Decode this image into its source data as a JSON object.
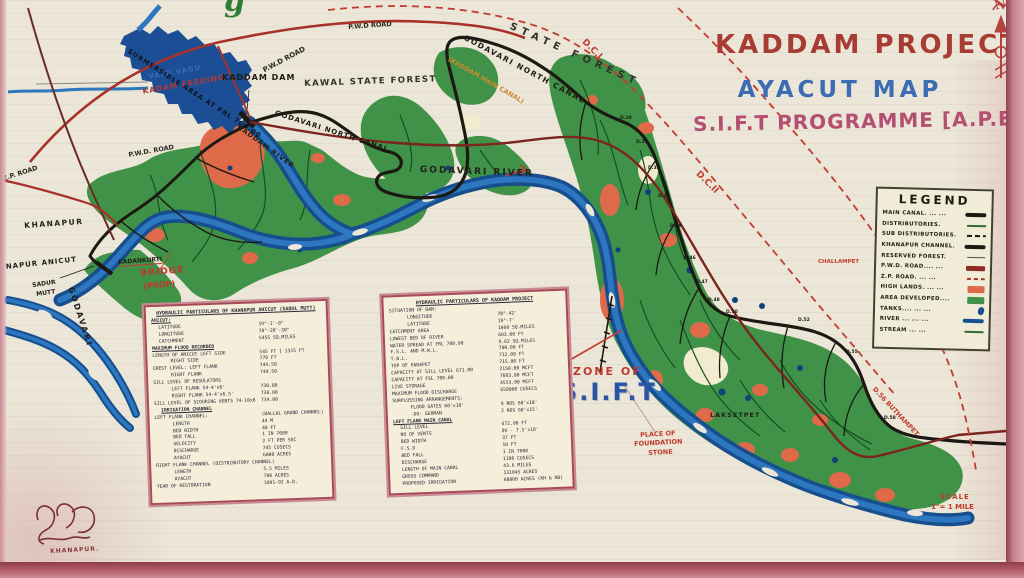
{
  "title": {
    "line1": "KADDAM PROJECT",
    "line2": "AYACUT MAP",
    "line3": "S.I.F.T PROGRAMME [A.P.E.R.P]"
  },
  "colors": {
    "title_red": "#a93b35",
    "title_blue": "#3c6cb3",
    "title_magenta": "#b44f72",
    "area_developed_green": "#3f9247",
    "high_lands_orange": "#df6a4a",
    "river_blue": "#17508e",
    "reservoir_blue": "#1c4e95",
    "canal_black": "#1b1912",
    "pwd_road_red": "#a8312a",
    "dashed_boundary_red": "#c33c2f",
    "paper": "#ebe6d7"
  },
  "compass": {
    "n": "N"
  },
  "watermark": "g",
  "legend": {
    "title": "LEGEND",
    "items": [
      {
        "label": "MAIN CANAL. ...  ...",
        "swatch": "black-thick-bar"
      },
      {
        "label": "DISTRIBUTORIES.",
        "swatch": "green-line"
      },
      {
        "label": "SUB DISTRIBUTORIES.",
        "swatch": "dark-dashed-line"
      },
      {
        "label": "KHANAPUR CHANNEL.",
        "swatch": "black-thick-bar"
      },
      {
        "label": "RESERVED FOREST.",
        "swatch": "thin-line"
      },
      {
        "label": "P.W.D. ROAD....  ...",
        "swatch": "dark-red-bar"
      },
      {
        "label": "Z.P. ROAD.  ...  ...",
        "swatch": "red-dashed-line"
      },
      {
        "label": "HIGH LANDS. ...  ...",
        "swatch": "orange-bar"
      },
      {
        "label": "AREA DEVELOPED....",
        "swatch": "green-bar"
      },
      {
        "label": "TANKS....  ...  ...",
        "swatch": "blue-teardrop"
      },
      {
        "label": "RIVER ...  ...  ...",
        "swatch": "blue-bar"
      },
      {
        "label": "STREAM  ...  ...",
        "swatch": "green-line"
      }
    ]
  },
  "tables": {
    "left": {
      "title": "HYDRAULIC PARTICULARS OF KHANAPUR ANICUT (SADUL MUTT)",
      "rows": [
        {
          "l": "ANICUT:",
          "v": ""
        },
        {
          "l": "LATITUDE",
          "v": "19°-1'-0\""
        },
        {
          "l": "LONGITUDE",
          "v": "78°-20'-30\""
        },
        {
          "l": "CATCHMENT",
          "v": "5455 SQ.MILES"
        },
        {
          "l": "MAXIMUM FLOOD RECORDED",
          "v": ""
        },
        {
          "l": "LENGTH OF ANICUT  LEFT SIDE",
          "v": "545 FT ] 1315 FT"
        },
        {
          "l": "RIGHT SIDE",
          "v": "770 FT"
        },
        {
          "l": "CREST LEVEL:   LEFT FLANK",
          "v": "744.50"
        },
        {
          "l": "RIGHT FLANK",
          "v": "744.50"
        },
        {
          "l": "SILL LEVEL OF REGULATORS",
          "v": ""
        },
        {
          "l": "LEFT FLANK   54-4'x6'",
          "v": "738.00"
        },
        {
          "l": "RIGHT FLANK  54-4'x6.5'",
          "v": "738.00"
        },
        {
          "l": "SILL LEVEL OF SCOURING VENTS 74-10x8",
          "v": "734.00"
        },
        {
          "l": "IRRIGATION CHANNEL",
          "v": ""
        },
        {
          "l": "LEFT FLANK CHANNEL:",
          "v": "(BALLAL GRAND CHANNEL)"
        },
        {
          "l": "LENGTH",
          "v": "44 M"
        },
        {
          "l": "BED WIDTH",
          "v": "40 FT"
        },
        {
          "l": "BED FALL",
          "v": "1 IN 7000"
        },
        {
          "l": "VELOCITY",
          "v": "2 FT PER SEC"
        },
        {
          "l": "DISCHARGE",
          "v": "745 CUSECS"
        },
        {
          "l": "AYACUT",
          "v": "6000 ACRES"
        },
        {
          "l": "RIGHT FLANK CHANNEL (DISTRIBUTORY CHANNEL)",
          "v": ""
        },
        {
          "l": "LENGTH",
          "v": "5.5 MILES"
        },
        {
          "l": "AYACUT",
          "v": "700 ACRES"
        },
        {
          "l": "YEAR OF RESTORATION",
          "v": "1891-92 A.D."
        }
      ]
    },
    "right": {
      "title": "HYDRAULIC PARTICULARS OF KADDAM PROJECT",
      "rows": [
        {
          "l": "SITUATION OF DAM:",
          "v": ""
        },
        {
          "l": "LONGITUDE",
          "v": "78°-42'"
        },
        {
          "l": "LATITUDE",
          "v": "19°-7'"
        },
        {
          "l": "CATCHMENT AREA",
          "v": "1060 SQ.MILES"
        },
        {
          "l": "LOWEST BED OF RIVER",
          "v": "603.00 FT"
        },
        {
          "l": "WATER SPREAD AT FRL 700.00",
          "v": "9.62 SQ.MILES"
        },
        {
          "l": "F.S.L. AND M.W.L.",
          "v": "700.00 FT"
        },
        {
          "l": "T.B.L.",
          "v": "712.00 FT"
        },
        {
          "l": "TOP OF PARAPET",
          "v": "715.00 FT"
        },
        {
          "l": "CAPACITY AT SILL LEVEL 671.00",
          "v": "2150.00 MCFT"
        },
        {
          "l": "CAPACITY AT FSL 700.00",
          "v": "7603.00 MCFT"
        },
        {
          "l": "LIVE STORAGE",
          "v": "4553.00 MCFT"
        },
        {
          "l": "MAXIMUM FLOOD DISCHARGE",
          "v": "650000 CUSECS"
        },
        {
          "l": "SURPLUSSING ARRANGEMENTS:",
          "v": ""
        },
        {
          "l": "FLOOD GATES  60'x18'",
          "v": "9 NOS 60'x18'"
        },
        {
          "l": "-DO-    GERMAN",
          "v": "2 NOS 60'x15'"
        },
        {
          "l": "LEFT FLANK MAIN CANAL",
          "v": ""
        },
        {
          "l": "SILL LEVEL",
          "v": "672.00 FT"
        },
        {
          "l": "NO OF VENTS",
          "v": "8V - 7.5'x10'"
        },
        {
          "l": "BED WIDTH",
          "v": "37 FT"
        },
        {
          "l": "F.S.D",
          "v": "10 FT"
        },
        {
          "l": "BED FALL",
          "v": "1 IN 7000"
        },
        {
          "l": "DISCHARGE",
          "v": "1100 CUSECS"
        },
        {
          "l": "LENGTH OF MAIN CANAL",
          "v": "43.6 MILES"
        },
        {
          "l": "GROSS COMMAND",
          "v": "131045 ACRES"
        },
        {
          "l": "PROPOSED IRRIGATION",
          "v": "68000 ACRES (KH & RB)"
        }
      ]
    }
  },
  "zone": {
    "line1": "ZONE OF",
    "line2": "S.I.F.T"
  },
  "foundation": {
    "l1": "PLACE OF",
    "l2": "FOUNDATION",
    "l3": "STONE"
  },
  "scale": {
    "l1": "SCALE",
    "l2": "1\"= 1 MILE"
  },
  "signature": "KHANAPUR.",
  "map": {
    "labels": {
      "valu_vagu": "VALU VAGU",
      "kadam_feeding": "KADAM FEEDING",
      "submersible": "SUBMERSIBLE AREA AT FRL 700.00",
      "kaddam_dam": "KADDAM DAM",
      "pwd_road_1": "P.W.D. ROAD",
      "pwd_road_2": "P.W.D ROAD",
      "pwd_road_3": "P.W.D ROAD",
      "zp_road": "Z.P. ROAD",
      "kawal_forest": "KAWAL STATE FOREST",
      "state_forest": "STATE FOREST",
      "gnc1": "GODAVARI NORTH CANAL",
      "gnc2": "GODAVARI NORTH CANAL",
      "kaddam_main_canal": "(KADDAM MAIN CANAL)",
      "dci": "D.C.I",
      "dcii": "D.C.II",
      "kaddam_river": "KADDAM RIVER",
      "godavari_river": "GODAVARI RIVER",
      "godavari": "GODAVARI",
      "khanapur": "KHANAPUR",
      "khanapur_anicut": "KHANAPUR ANICUT",
      "sadur_mutt_1": "SADUR",
      "sadur_mutt_2": "MUTT",
      "kadankurti": "KADANKURTI",
      "bridge": "BRIDGE",
      "prop": "(PROP)",
      "laksetpet": "LAKSETPET",
      "challampet": "CHALLAMPET",
      "buthampet": "D.56 BUTHAMPET"
    },
    "distributaries": [
      "D.28",
      "D.29",
      "D.33",
      "D.36",
      "D.39",
      "D.46",
      "D.47",
      "D.48",
      "D.50",
      "D.52",
      "D.55",
      "D.58"
    ]
  }
}
